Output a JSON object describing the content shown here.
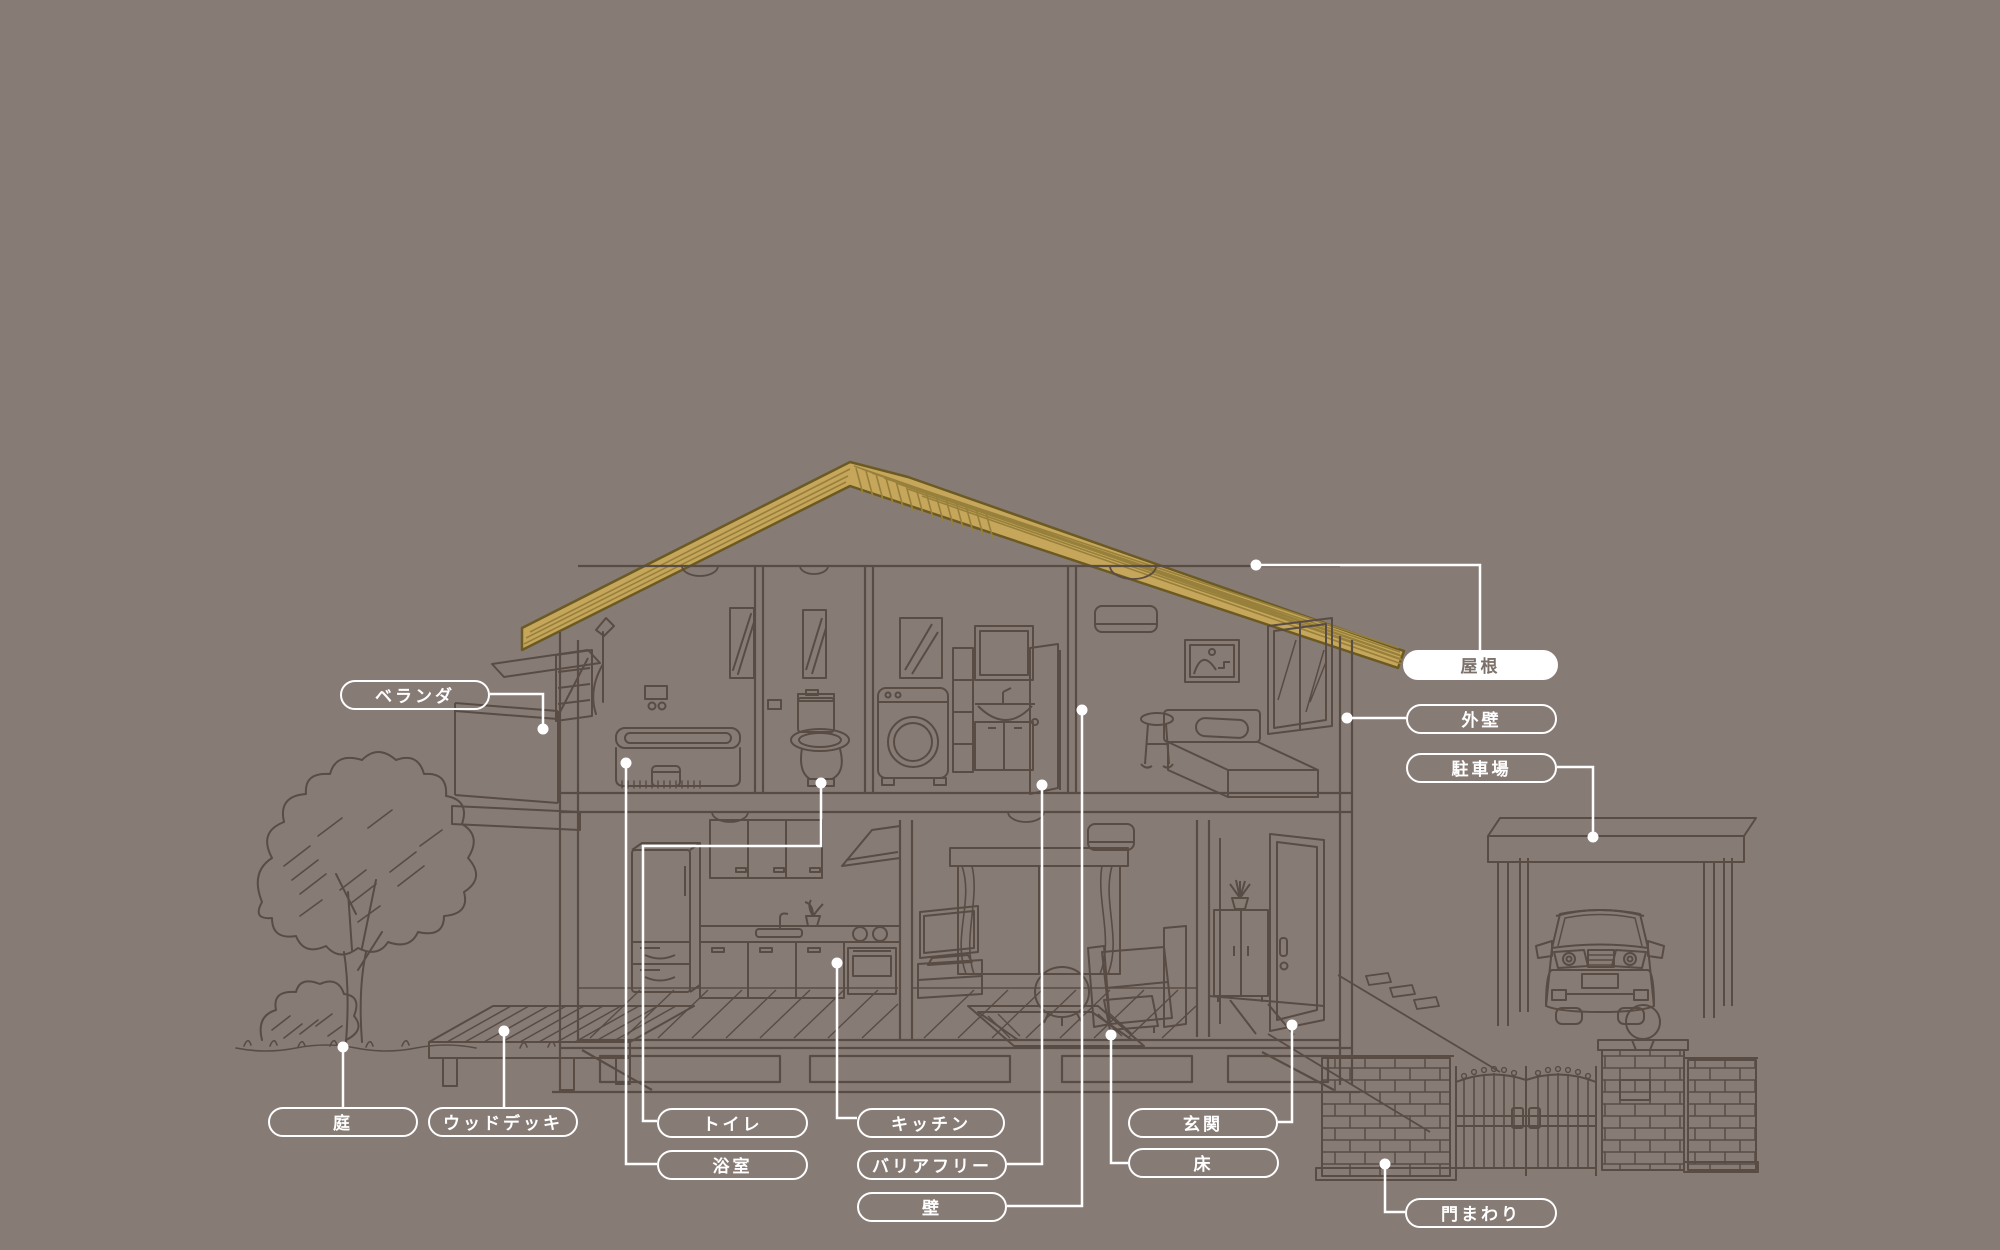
{
  "diagram": {
    "subject": "two-story house cross-section with exterior, renovation parts diagram"
  },
  "labels": {
    "veranda": {
      "text": "ベランダ",
      "style": "outline"
    },
    "roof": {
      "text": "屋根",
      "style": "filled"
    },
    "exterior_wall": {
      "text": "外壁",
      "style": "outline"
    },
    "parking": {
      "text": "駐車場",
      "style": "outline"
    },
    "garden": {
      "text": "庭",
      "style": "outline"
    },
    "wood_deck": {
      "text": "ウッドデッキ",
      "style": "outline"
    },
    "toilet": {
      "text": "トイレ",
      "style": "outline"
    },
    "bathroom": {
      "text": "浴室",
      "style": "outline"
    },
    "kitchen": {
      "text": "キッチン",
      "style": "outline"
    },
    "barrier_free": {
      "text": "バリアフリー",
      "style": "outline"
    },
    "wall": {
      "text": "壁",
      "style": "outline"
    },
    "entrance": {
      "text": "玄関",
      "style": "outline"
    },
    "floor": {
      "text": "床",
      "style": "outline"
    },
    "gate_area": {
      "text": "門まわり",
      "style": "outline"
    }
  },
  "colors": {
    "background": "#877B76",
    "line": "#584C45",
    "roof_fill": "#C6A65A",
    "roof_stripe": "#97803C",
    "roof_outline": "#6B5A22",
    "label_border": "#FFFFFF",
    "label_text": "#FFFFFF",
    "roof_label_bg": "#FFFFFF",
    "roof_label_text": "#7C7069",
    "leader": "#FFFFFF"
  }
}
